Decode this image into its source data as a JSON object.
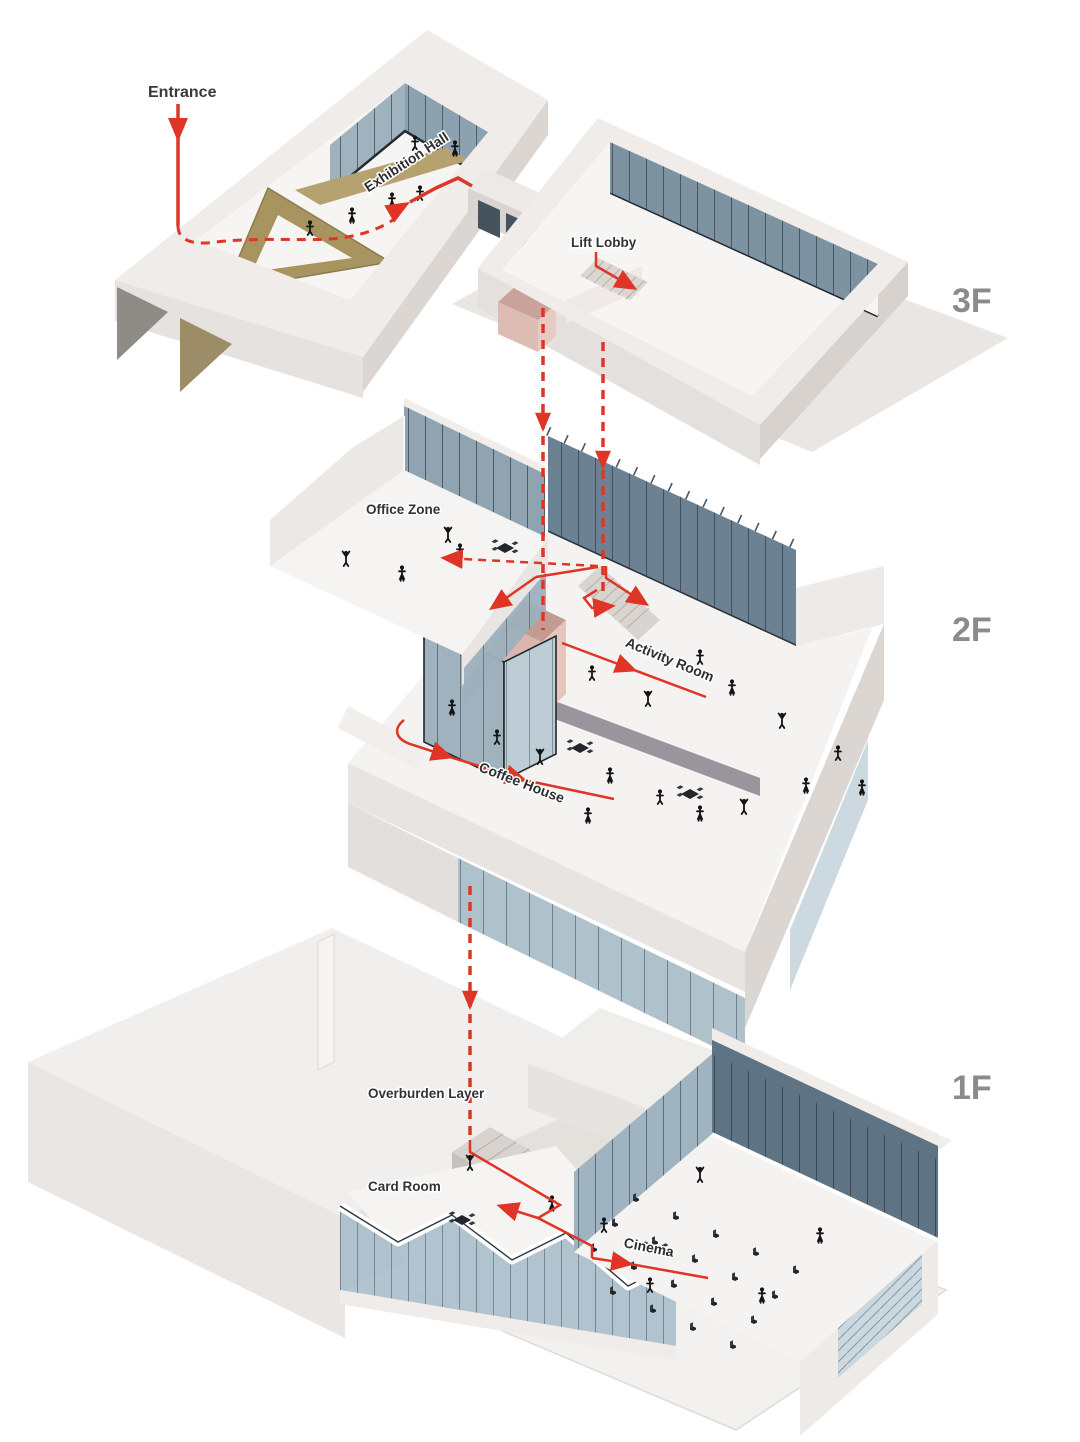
{
  "diagram": {
    "type": "exploded-axonometric-circulation",
    "floors": [
      {
        "label": "3F",
        "rooms": [
          "Exhibition Hall",
          "Lift Lobby"
        ]
      },
      {
        "label": "2F",
        "rooms": [
          "Office Zone",
          "Activity Room",
          "Coffee House"
        ]
      },
      {
        "label": "1F",
        "rooms": [
          "Overburden Layer",
          "Card Room",
          "Cinema"
        ]
      }
    ]
  },
  "labels": {
    "entrance": "Entrance",
    "exhibition_hall": "Exhibition Hall",
    "lift_lobby": "Lift Lobby",
    "office_zone": "Office Zone",
    "activity_room": "Activity Room",
    "coffee_house": "Coffee House",
    "overburden_layer": "Overburden Layer",
    "card_room": "Card Room",
    "cinema": "Cinema",
    "floor_3f": "3F",
    "floor_2f": "2F",
    "floor_1f": "1F"
  },
  "colors": {
    "circulation_red": "#DE3526",
    "floor_label_gray": "#8B8B8B",
    "room_label_dark": "#333333",
    "wall_white": "#EFECEA",
    "glass_blue": "#7E93A2",
    "timber_tan": "#A8945F",
    "core_pink": "#D9B7AE",
    "background": "#FFFFFF"
  }
}
